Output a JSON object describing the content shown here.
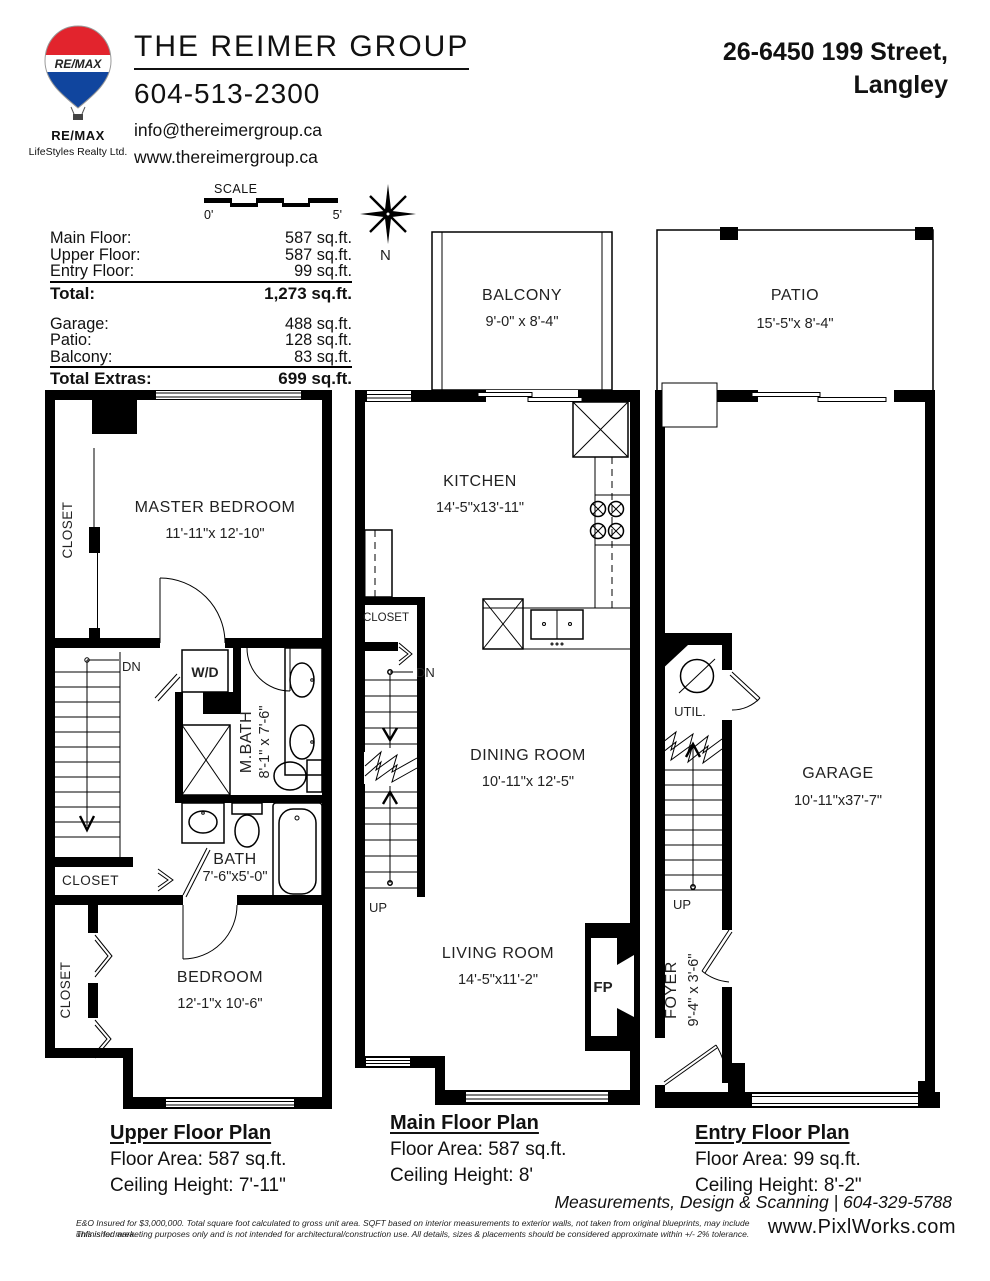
{
  "colors": {
    "remax_red": "#e2242d",
    "remax_blue": "#10459e"
  },
  "header": {
    "brand": "THE REIMER GROUP",
    "phone": "604-513-2300",
    "email": "info@thereimergroup.ca",
    "website": "www.thereimergroup.ca",
    "address_line1": "26-6450 199 Street,",
    "address_line2": "Langley",
    "logo": {
      "balloon_text": "RE/MAX",
      "name": "RE/MAX",
      "company": "LifeStyles Realty Ltd."
    }
  },
  "scale_bar": {
    "label": "SCALE",
    "start": "0'",
    "end": "5'"
  },
  "compass": {
    "north": "N"
  },
  "summary": {
    "floors": [
      {
        "label": "Main Floor:",
        "value": "587 sq.ft."
      },
      {
        "label": "Upper Floor:",
        "value": "587 sq.ft."
      },
      {
        "label": "Entry Floor:",
        "value": "99 sq.ft."
      }
    ],
    "total": {
      "label": "Total:",
      "value": "1,273 sq.ft."
    },
    "extras": [
      {
        "label": "Garage:",
        "value": "488 sq.ft."
      },
      {
        "label": "Patio:",
        "value": "128 sq.ft."
      },
      {
        "label": "Balcony:",
        "value": "83 sq.ft."
      }
    ],
    "total_extras": {
      "label": "Total Extras:",
      "value": "699 sq.ft."
    }
  },
  "plans": {
    "upper": {
      "title": "Upper Floor Plan",
      "area": "Floor Area: 587 sq.ft.",
      "ceiling": "Ceiling Height: 7'-11\"",
      "rooms": {
        "master": {
          "name": "MASTER BEDROOM",
          "dims": "11'-11\"x 12'-10\""
        },
        "closet_top": "CLOSET",
        "wd": "W/D",
        "dn": "DN",
        "mbath": {
          "name": "M.BATH",
          "dims": "8'-1\" x 7'-6\""
        },
        "bath": {
          "name": "BATH",
          "dims": "7'-6\"x5'-0\""
        },
        "closet_mid": "CLOSET",
        "bedroom": {
          "name": "BEDROOM",
          "dims": "12'-1\"x 10'-6\""
        },
        "closet_bottom": "CLOSET"
      }
    },
    "main": {
      "title": "Main Floor Plan",
      "area": "Floor Area: 587 sq.ft.",
      "ceiling": "Ceiling Height: 8'",
      "rooms": {
        "balcony": {
          "name": "BALCONY",
          "dims": "9'-0\" x 8'-4\""
        },
        "kitchen": {
          "name": "KITCHEN",
          "dims": "14'-5\"x13'-11\""
        },
        "closet": "CLOSET",
        "dn": "DN",
        "up": "UP",
        "dining": {
          "name": "DINING ROOM",
          "dims": "10'-11\"x 12'-5\""
        },
        "living": {
          "name": "LIVING ROOM",
          "dims": "14'-5\"x11'-2\""
        },
        "fireplace": "FP"
      }
    },
    "entry": {
      "title": "Entry Floor Plan",
      "area": "Floor Area: 99 sq.ft.",
      "ceiling": "Ceiling Height: 8'-2\"",
      "rooms": {
        "patio": {
          "name": "PATIO",
          "dims": "15'-5\"x 8'-4\""
        },
        "util": "UTIL.",
        "up": "UP",
        "garage": {
          "name": "GARAGE",
          "dims": "10'-11\"x37'-7\""
        },
        "foyer": {
          "name": "FOYER",
          "dims": "9'-4\" x 3'-6\""
        }
      }
    }
  },
  "footer": {
    "services": "Measurements, Design & Scanning | 604-329-5788",
    "disclaimer1": "E&O Insured for $3,000,000.  Total square foot calculated to gross unit area. SQFT based on interior measurements to exterior walls, not taken from original blueprints, may include unfinished area.",
    "disclaimer2": "This is for marketing purposes only and is not intended for architectural/construction use.  All details, sizes & placements should be considered approximate within +/- 2%  tolerance.",
    "credit": "www.PixlWorks.com"
  }
}
